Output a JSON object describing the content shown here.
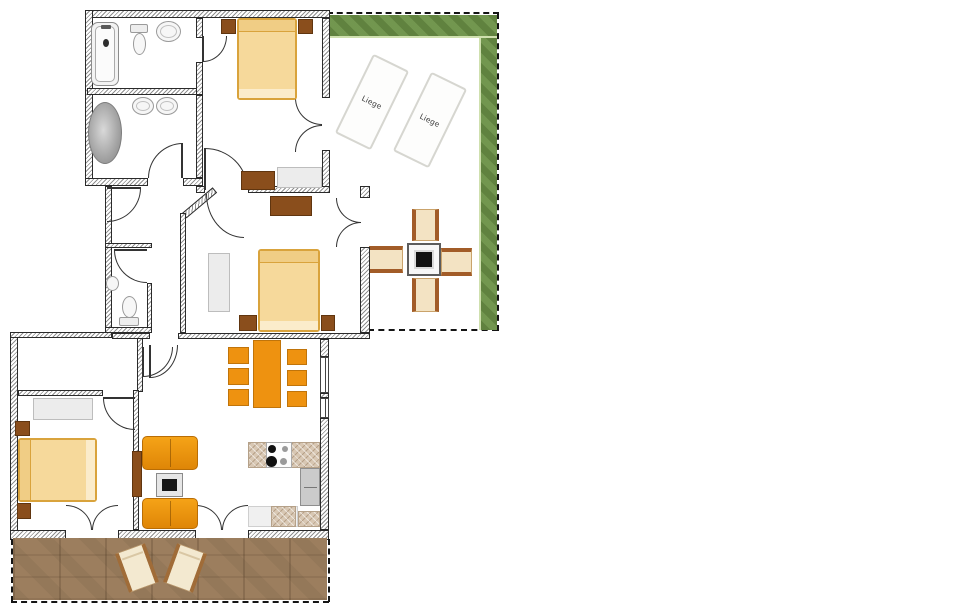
{
  "plan": {
    "type": "apartment-floor-plan",
    "labels": {
      "lounger_1": "Liege",
      "lounger_2": "Liege"
    },
    "colors": {
      "grass": "#6b9146",
      "grass_edge": "#cfe0ae",
      "deck_wood": "#9c7e5e",
      "wall_line": "#2a2a2a",
      "bed_fill": "#f6d99b",
      "bed_border": "#d9a33c",
      "furniture_brown": "#8a4e1c",
      "furniture_orange": "#ee9210",
      "counter_beige": "#d8c7b3",
      "chair_beige": "#f3e3c3",
      "chair_rail_brown": "#a25c28",
      "wardrobe_gray": "#ececec",
      "table_top_black": "#161616"
    },
    "symbols": [
      "bathtub",
      "toilet",
      "sink",
      "oval-tub",
      "double-bed",
      "single-bed",
      "nightstand",
      "wardrobe",
      "dresser",
      "desk",
      "dining-table",
      "dining-chair",
      "sofa",
      "coffee-table",
      "tv-board",
      "stove",
      "kitchen-counter",
      "tall-cabinet",
      "sun-lounger",
      "patio-table",
      "patio-chair",
      "door-swing",
      "window",
      "grass-strip",
      "wood-deck"
    ]
  }
}
